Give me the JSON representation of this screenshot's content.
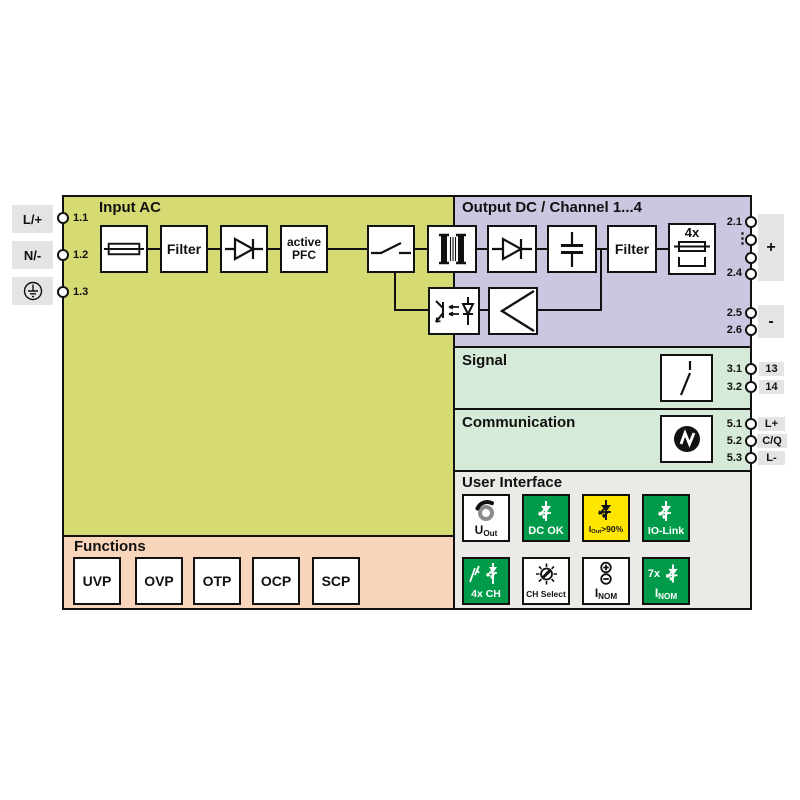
{
  "sections": {
    "input_ac": {
      "title": "Input AC"
    },
    "output_dc": {
      "title": "Output DC / Channel 1...4"
    },
    "signal": {
      "title": "Signal"
    },
    "communication": {
      "title": "Communication"
    },
    "user_interface": {
      "title": "User Interface"
    },
    "functions": {
      "title": "Functions"
    }
  },
  "blocks": {
    "filter_in": "Filter",
    "active_pfc_line1": "active",
    "active_pfc_line2": "PFC",
    "filter_out": "Filter",
    "fuse_multi": "4x"
  },
  "input_terminals": {
    "pins": [
      "1.1",
      "1.2",
      "1.3"
    ],
    "connectors": [
      "L/+",
      "N/-"
    ]
  },
  "output_terminals": {
    "plus": {
      "pin_top": "2.1",
      "pin_bottom": "2.4",
      "ellipsis": "⋮",
      "label": "+"
    },
    "minus": {
      "pin_top": "2.5",
      "pin_bottom": "2.6",
      "label": "-"
    }
  },
  "signal_terminals": {
    "pins": [
      "3.1",
      "3.2"
    ],
    "labels": [
      "13",
      "14"
    ]
  },
  "comm_terminals": {
    "pins": [
      "5.1",
      "5.2",
      "5.3"
    ],
    "labels": [
      "L+",
      "C/Q",
      "L-"
    ]
  },
  "user_interface": {
    "tiles": {
      "uout": {
        "main": "U",
        "sub": "Out"
      },
      "dc_ok": {
        "label": "DC OK"
      },
      "iout90": {
        "main": "I",
        "sub": "Out",
        "suffix": ">90%"
      },
      "io_link": {
        "label": "IO-Link"
      },
      "ch4x": {
        "label": "4x CH"
      },
      "ch_select": {
        "label": "CH Select"
      },
      "inom_adjust": {
        "main": "I",
        "sub": "NOM"
      },
      "inom_7x": {
        "prefix": "7x",
        "main": "I",
        "sub": "NOM"
      }
    }
  },
  "functions": {
    "items": [
      "UVP",
      "OVP",
      "OTP",
      "OCP",
      "SCP"
    ]
  },
  "colors": {
    "input_bg": "#d6da72",
    "output_bg": "#cbc7e1",
    "signal_bg": "#d5ead9",
    "ui_bg": "#ebeae7",
    "functions_bg": "#f9d5bc",
    "led_green": "#009b4a",
    "led_yellow": "#ffe600",
    "terminal_gray": "#e4e4e2"
  }
}
